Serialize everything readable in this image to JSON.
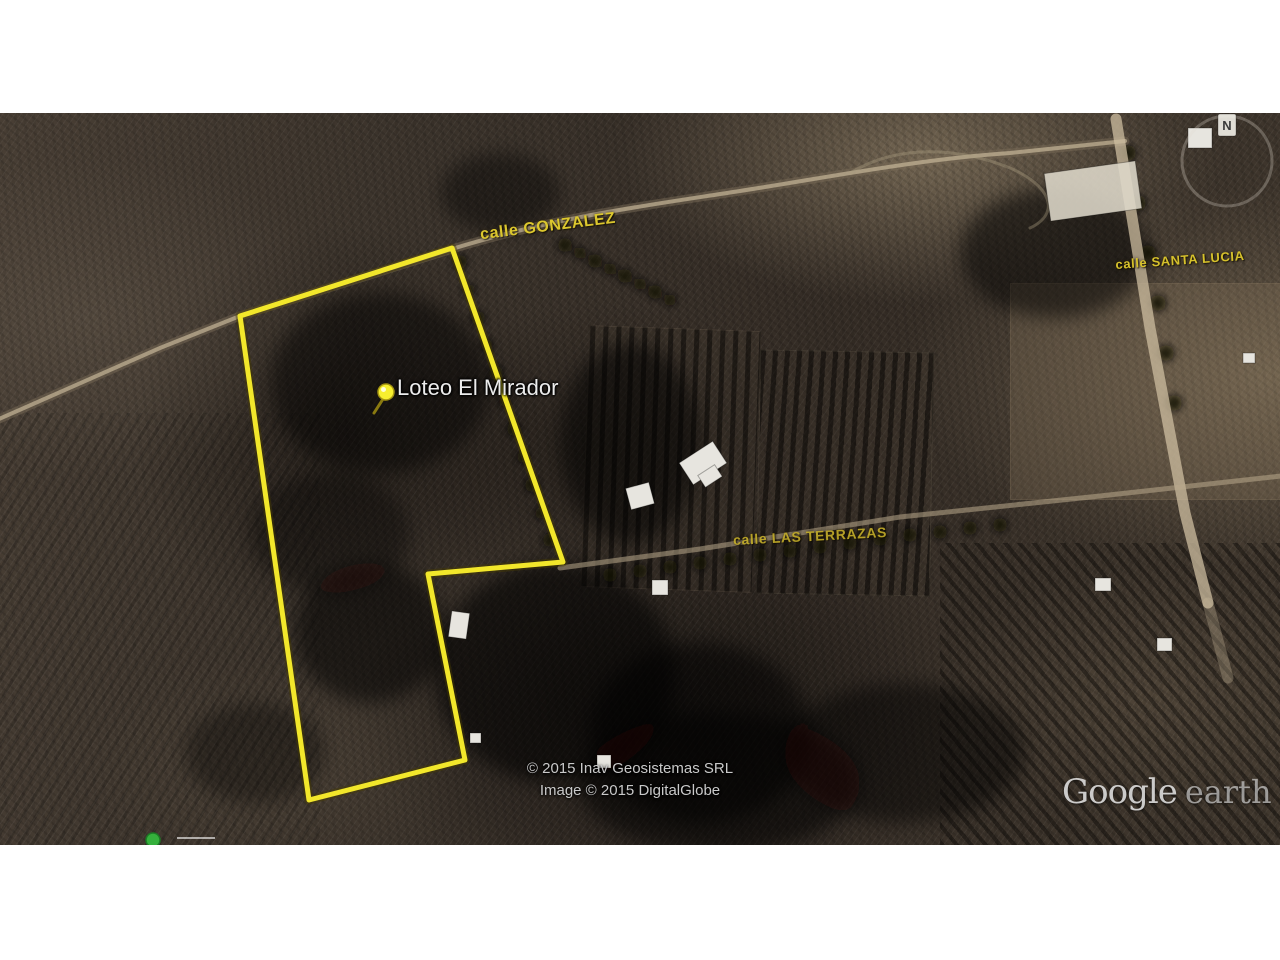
{
  "map": {
    "place": {
      "label": "Loteo El Mirador"
    },
    "streets": {
      "gonzalez": "calle GONZALEZ",
      "santa_lucia": "calle SANTA LUCIA",
      "las_terrazas": "calle LAS TERRAZAS"
    },
    "attribution": {
      "line1": "© 2015 Inav Geosistemas SRL",
      "line2": "Image © 2015 DigitalGlobe"
    },
    "logo": {
      "brand": "Google",
      "product": "earth"
    },
    "compass": {
      "north_label": "N"
    },
    "colors": {
      "street_label": "#d9c42d",
      "parcel_outline": "#f2e72b",
      "place_label": "#ececec",
      "attribution_text": "#c9c9c9",
      "placemark_green": "#35b03c"
    }
  }
}
